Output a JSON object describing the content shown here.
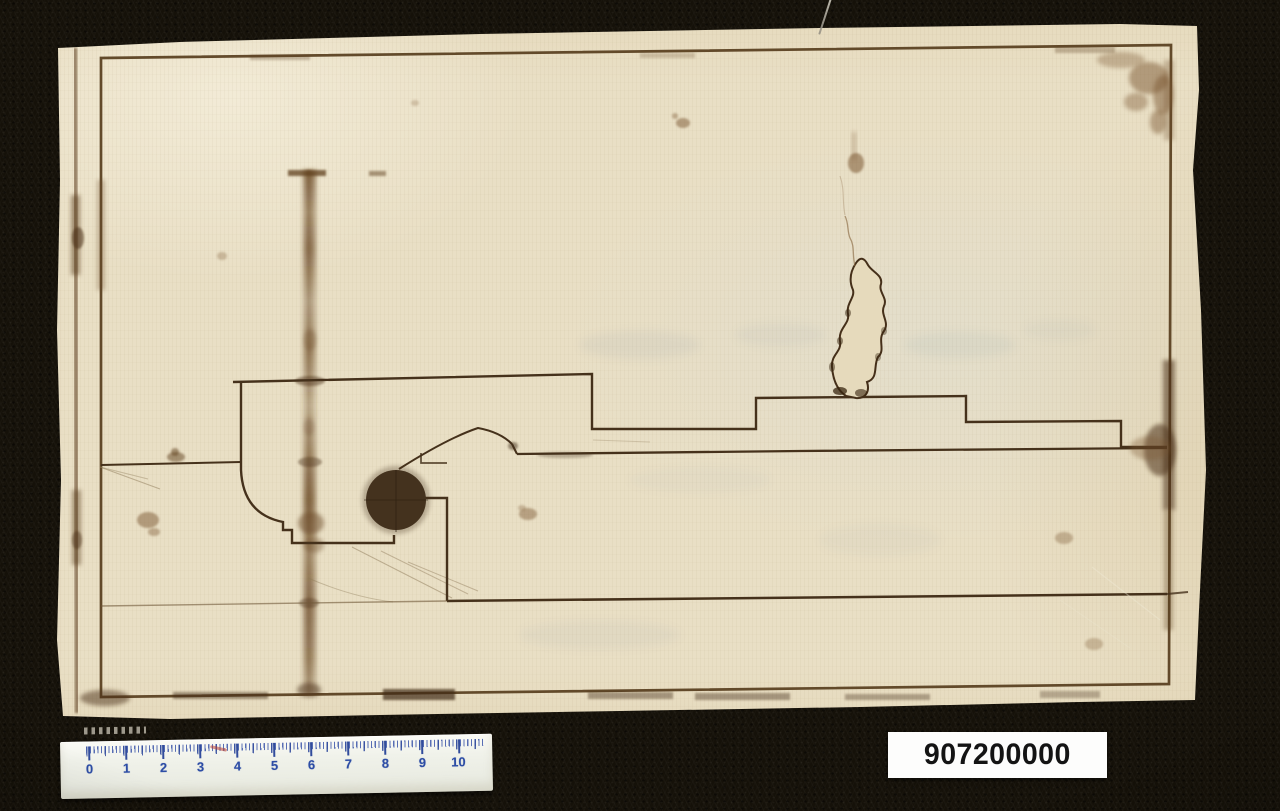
{
  "artifact": {
    "catalog_number": "907200000"
  },
  "ruler": {
    "unit_labels": [
      "0",
      "1",
      "2",
      "3",
      "4",
      "5",
      "6",
      "7",
      "8",
      "9",
      "10"
    ]
  },
  "colors": {
    "backdrop": "#151109",
    "paper": "#e9dfc5",
    "ink_line": "#45311b",
    "frame_ink": "#5b4122",
    "stain": "#7a5730",
    "filled_circle": "#44321e",
    "bleedthrough": "#8897aa",
    "ruler_bg": "#f0f2ea",
    "ruler_tick_blue": "#314c9c",
    "ruler_number_blue": "#2d4da5",
    "catalog_bg": "#fdfdfc",
    "catalog_text": "#141414"
  }
}
